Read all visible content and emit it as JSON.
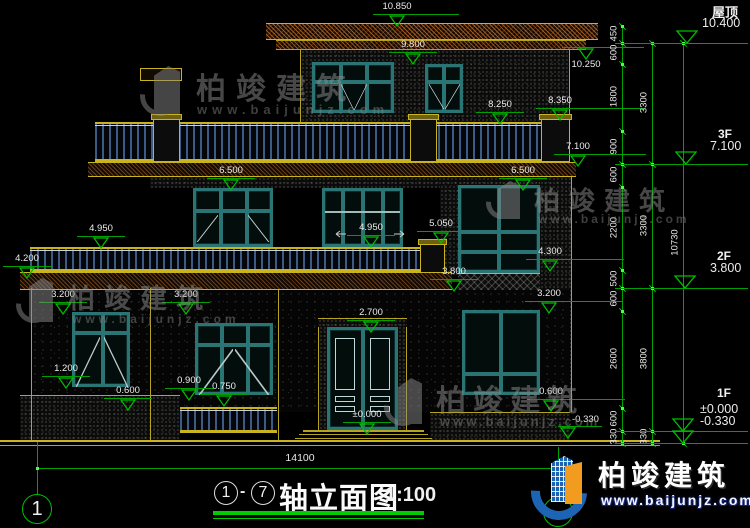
{
  "watermark": {
    "brand": "柏竣建筑",
    "url": "www.baijunjz.com"
  },
  "brand_logo": {
    "name": "柏竣建筑",
    "url": "www.baijunjz.com"
  },
  "titlebar": {
    "axis_from": "1",
    "axis_to": "7",
    "dash": "-",
    "title": "轴立面图",
    "scale": "1:100",
    "overall_width_dim": "14100",
    "axis_bubble_left": "1"
  },
  "right_legend": {
    "roof_label": "屋顶",
    "roof_level": "10.400",
    "f3_label": "3F",
    "f3_level": "7.100",
    "f2_label": "2F",
    "f2_level": "3.800",
    "f1_label": "1F",
    "f1_level_a": "±0.000",
    "f1_level_b": "-0.330"
  },
  "level_markers": [
    {
      "v": "10.850",
      "x": 397,
      "y": 26,
      "ext": 38
    },
    {
      "v": "9.800",
      "x": 413,
      "y": 64
    },
    {
      "v": "10.250",
      "x": 586,
      "y": 47,
      "pos": "below",
      "ext": 34
    },
    {
      "v": "8.250",
      "x": 500,
      "y": 124
    },
    {
      "v": "8.350",
      "x": 560,
      "y": 120,
      "ext": 60
    },
    {
      "v": "7.100",
      "x": 578,
      "y": 166,
      "ext": 44
    },
    {
      "v": "6.500",
      "x": 523,
      "y": 190
    },
    {
      "v": "6.500",
      "x": 231,
      "y": 190
    },
    {
      "v": "4.950",
      "x": 101,
      "y": 248
    },
    {
      "v": "4.950",
      "x": 371,
      "y": 247,
      "arrows": true
    },
    {
      "v": "5.050",
      "x": 441,
      "y": 243
    },
    {
      "v": "4.200",
      "x": 27,
      "y": 278
    },
    {
      "v": "4.300",
      "x": 550,
      "y": 271,
      "ext": 50
    },
    {
      "v": "3.800",
      "x": 454,
      "y": 291
    },
    {
      "v": "3.200",
      "x": 63,
      "y": 314
    },
    {
      "v": "3.200",
      "x": 186,
      "y": 314
    },
    {
      "v": "3.200",
      "x": 549,
      "y": 313,
      "ext": 50
    },
    {
      "v": "2.700",
      "x": 371,
      "y": 332
    },
    {
      "v": "1.200",
      "x": 66,
      "y": 388
    },
    {
      "v": "0.900",
      "x": 189,
      "y": 400
    },
    {
      "v": "0.750",
      "x": 224,
      "y": 406
    },
    {
      "v": "0.600",
      "x": 128,
      "y": 410
    },
    {
      "v": "0.600",
      "x": 551,
      "y": 411,
      "ext": 50
    },
    {
      "v": "±0.000",
      "x": 367,
      "y": 434
    },
    {
      "v": "-0.330",
      "x": 568,
      "y": 438,
      "pos": "right"
    }
  ],
  "dim_chains": [
    {
      "x": 622,
      "ticks": [
        26,
        43,
        64,
        131,
        164,
        187,
        270,
        288,
        311,
        408,
        431,
        443
      ],
      "labels": [
        {
          "t": "450",
          "y": 34
        },
        {
          "t": "600",
          "y": 53
        },
        {
          "t": "1800",
          "y": 97
        },
        {
          "t": "900",
          "y": 147
        },
        {
          "t": "600",
          "y": 175
        },
        {
          "t": "2200",
          "y": 228
        },
        {
          "t": "500",
          "y": 279
        },
        {
          "t": "600",
          "y": 299
        },
        {
          "t": "2600",
          "y": 359
        },
        {
          "t": "600",
          "y": 419
        },
        {
          "t": "330",
          "y": 437
        }
      ]
    },
    {
      "x": 652,
      "ticks": [
        43,
        164,
        288,
        431,
        443
      ],
      "labels": [
        {
          "t": "3300",
          "y": 103
        },
        {
          "t": "3300",
          "y": 226
        },
        {
          "t": "3800",
          "y": 359
        },
        {
          "t": "330",
          "y": 437
        }
      ]
    },
    {
      "x": 683,
      "ticks": [
        43,
        443
      ],
      "labels": [
        {
          "t": "10730",
          "y": 243
        }
      ]
    }
  ],
  "level_lines": [
    43,
    164,
    288,
    431,
    443
  ]
}
